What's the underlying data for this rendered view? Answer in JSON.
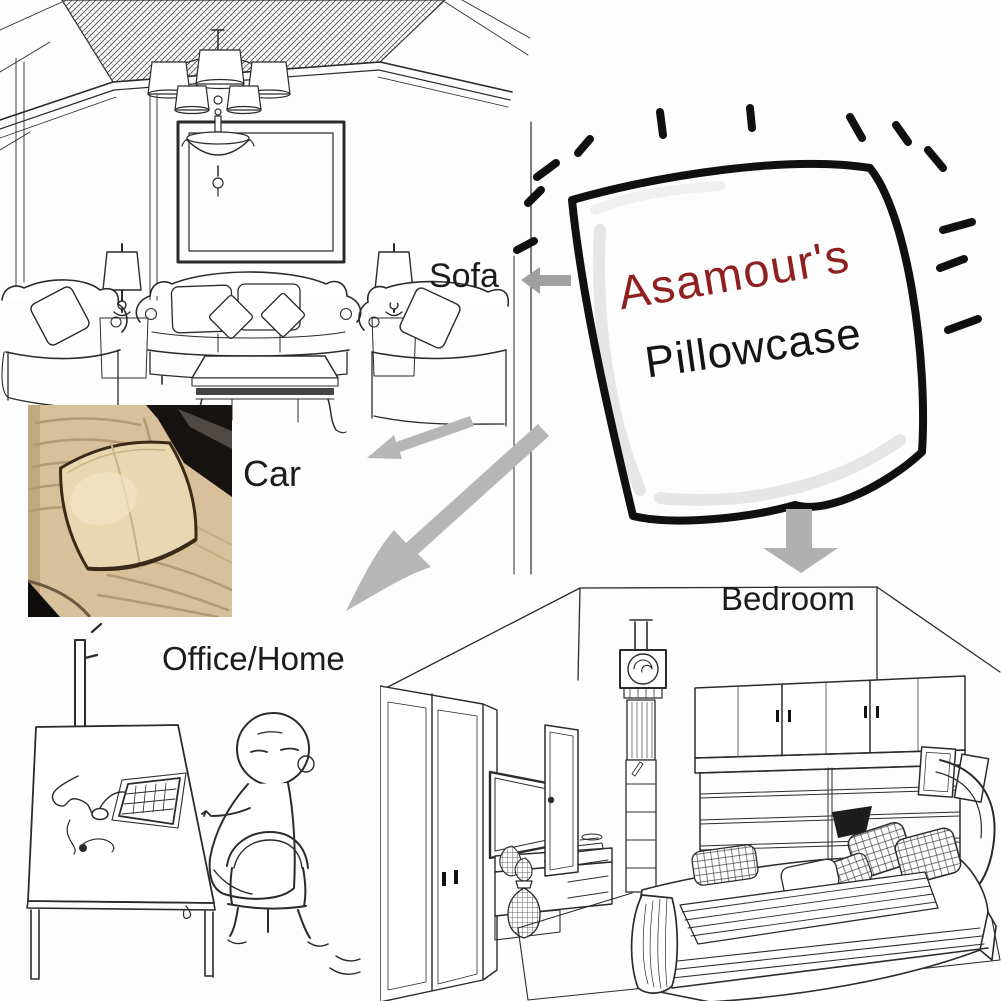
{
  "brand": {
    "name": "Asamour's",
    "product": "Pillowcase",
    "name_color": "#8e2020",
    "product_color": "#141414"
  },
  "scenes": {
    "sofa": {
      "label": "Sofa",
      "illustration": "line-art-living-room"
    },
    "car": {
      "label": "Car",
      "illustration": "photo-car-seat-with-pillow"
    },
    "office": {
      "label": "Office/Home",
      "illustration": "line-art-person-at-desk"
    },
    "bedroom": {
      "label": "Bedroom",
      "illustration": "line-art-bedroom"
    }
  },
  "colors": {
    "label_text": "#1c1c1c",
    "arrow_gray": "#b5b5b5",
    "line_art": "#2b2b2b",
    "pillow_outline": "#101010",
    "car_seat_beige": "#d8c09a",
    "car_pillow_beige": "#e8d7b1",
    "car_piping_brown": "#3a2b19",
    "car_console_black": "#171310",
    "car_buckle_red": "#b5473c"
  }
}
